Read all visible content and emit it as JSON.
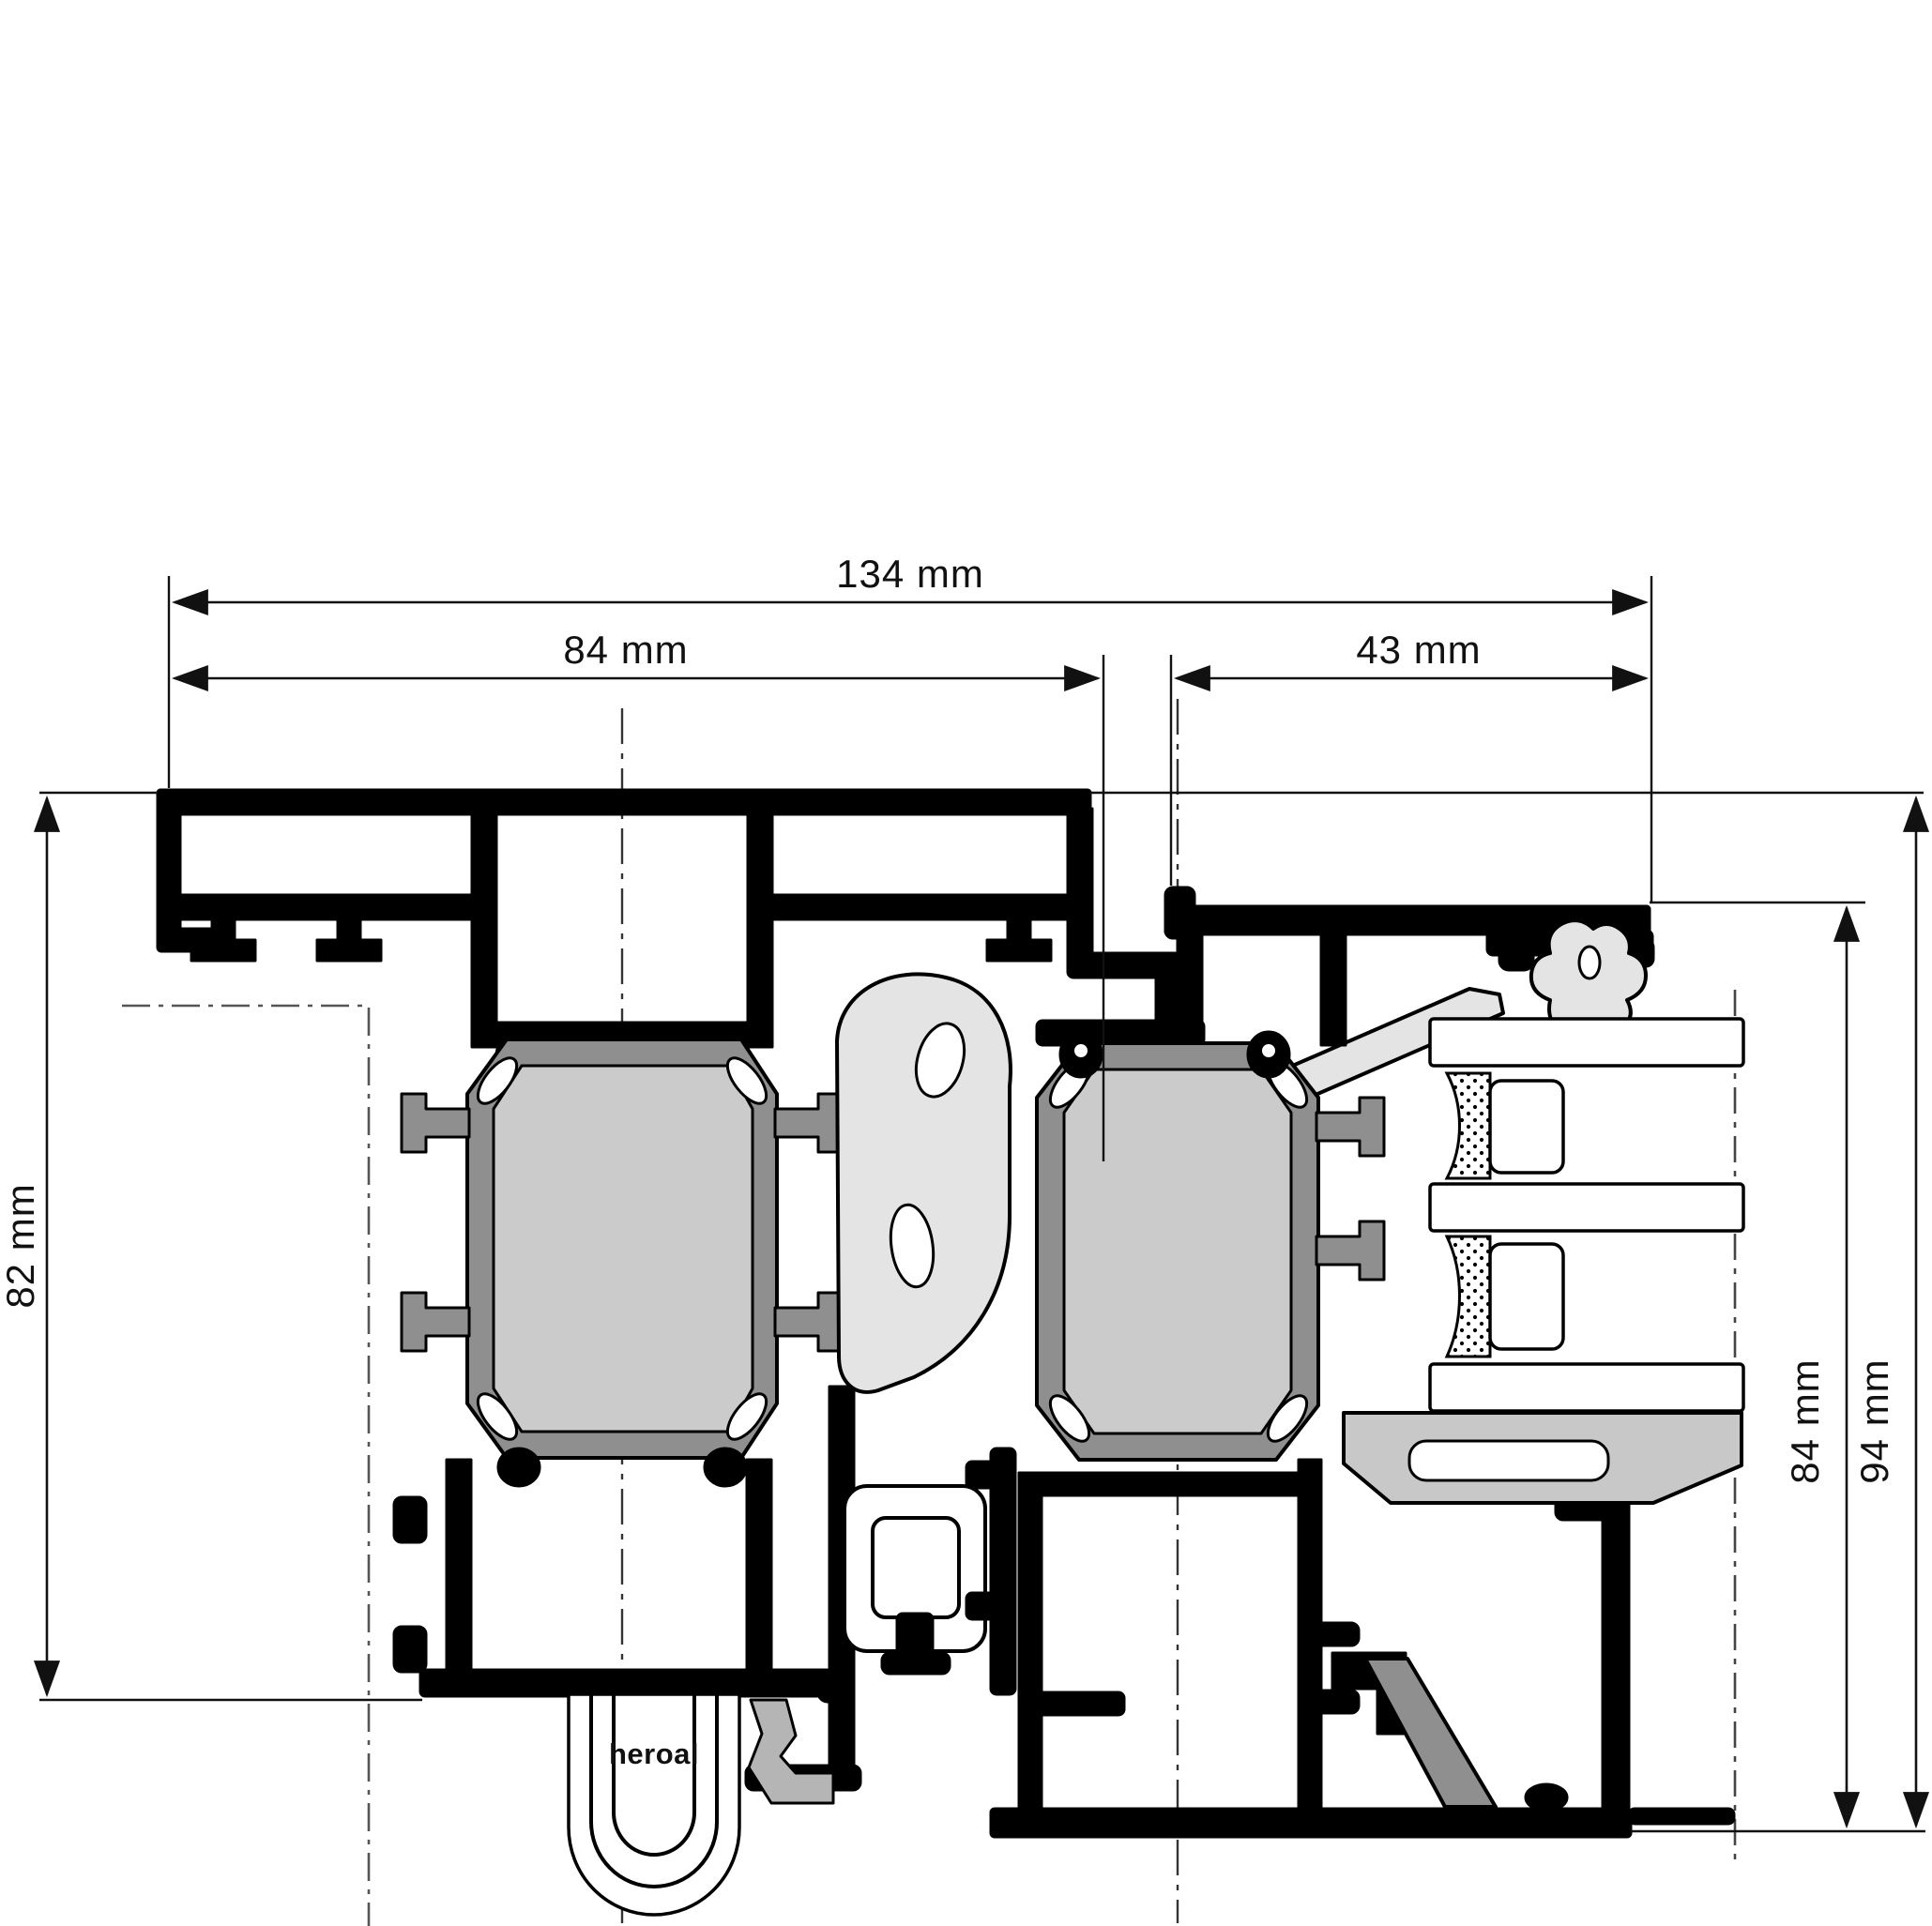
{
  "drawing": {
    "type": "technical-cross-section",
    "subject": "heroal aluminium door/window profile section with triple glazing",
    "dims": {
      "total_width": "134 mm",
      "frame_width": "84 mm",
      "sash_width": "43 mm",
      "frame_height": "82 mm",
      "sash_height": "84 mm",
      "total_height": "94 mm"
    },
    "logo": {
      "text": "heroal"
    },
    "colors": {
      "outline": "#000000",
      "insulation_fill": "#cbcbcb",
      "strut_gray": "#8f8f8f",
      "gasket_gray": "#e4e4e4",
      "support_gray": "#c8c8c8",
      "mid_gray": "#b5b5b5",
      "background": "#ffffff"
    }
  }
}
